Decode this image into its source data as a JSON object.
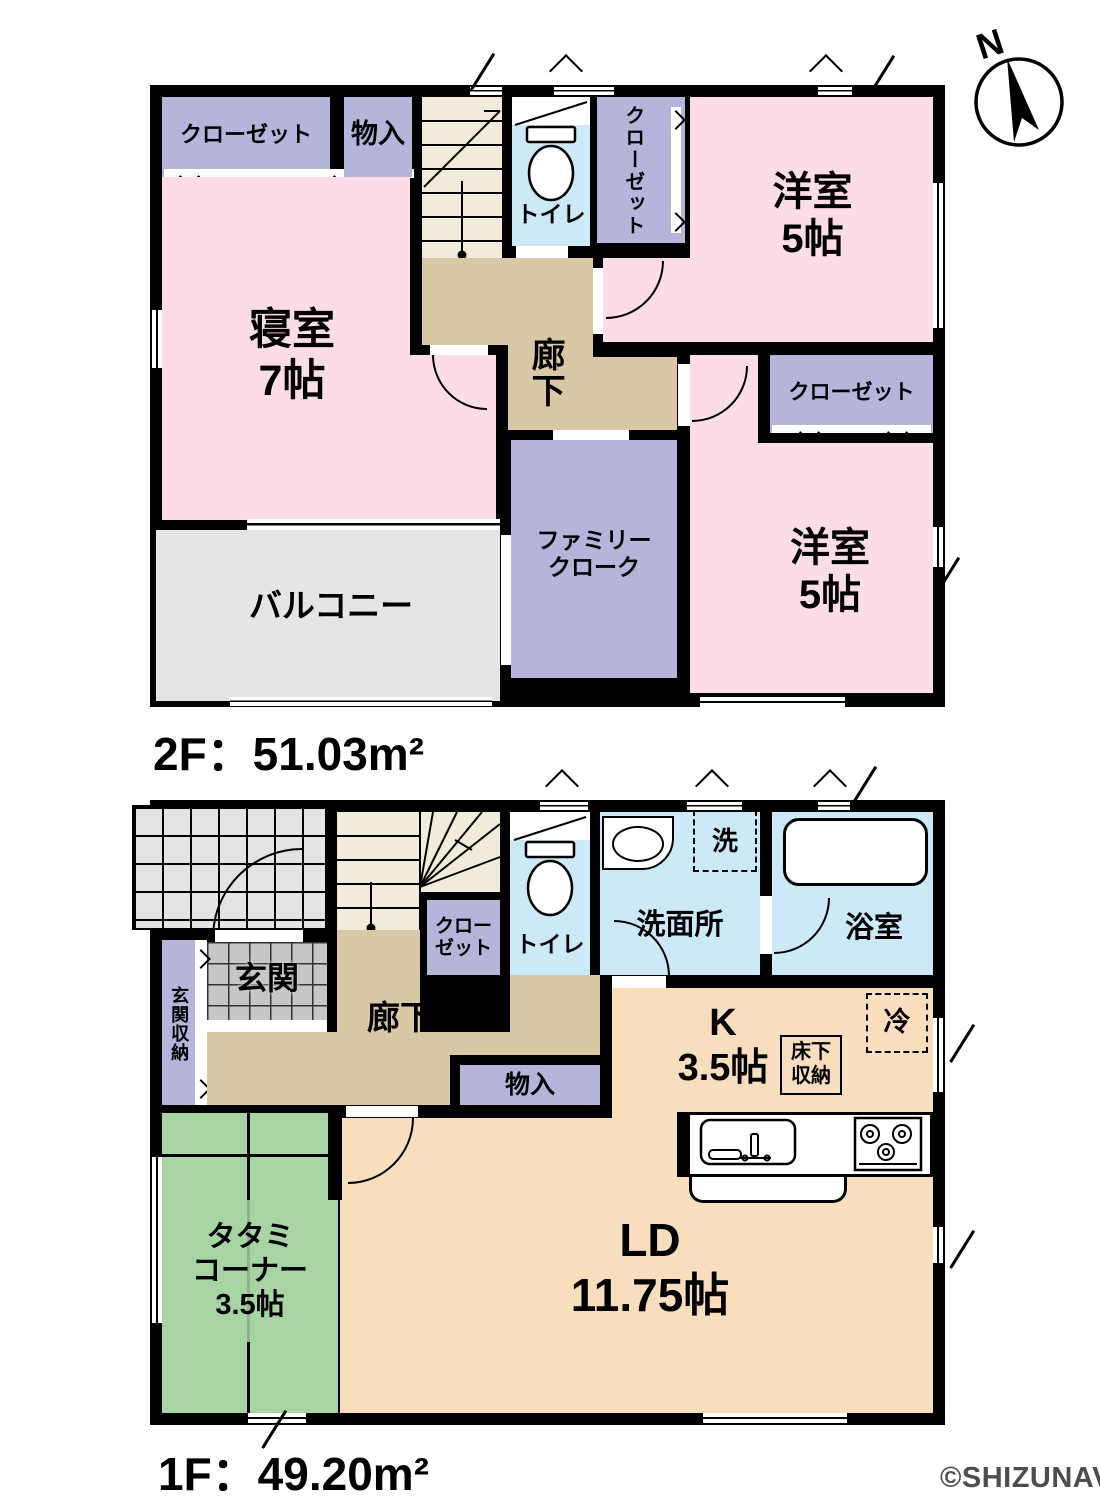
{
  "compass": {
    "label": "N"
  },
  "watermark": {
    "label": "©SHIZUNAVI"
  },
  "palette": {
    "wall": "#000000",
    "room_pink": "#FBDCE8",
    "closet_purple": "#B5B5DB",
    "hallway_tan": "#D9C8A4",
    "stairs_cream": "#F1ECDA",
    "water_blue": "#CBE9F6",
    "tatami_green": "#A7D4A3",
    "ld_peach": "#F8DEBD",
    "balcony_gray": "#E5E5E5",
    "porch_tile_gray": "#E3E3E3",
    "entrance_tile_gray": "#C7C7C7",
    "watermark_gray": "#4D4D4D"
  },
  "floor2": {
    "area_label": "2F：51.03m²",
    "rooms": {
      "closet_top_left": "クローゼット",
      "storage": "物入",
      "stairs_down": "DN",
      "toilet": "トイレ",
      "closet_upper": "クローゼット",
      "western_room_ne": "洋室\n5帖",
      "bedroom": "寝室\n7帖",
      "hallway": "廊下",
      "closet_east": "クローゼット",
      "family_closet": "ファミリー\nクローク",
      "western_room_se": "洋室\n5帖",
      "balcony": "バルコニー"
    }
  },
  "floor1": {
    "area_label": "1F：49.20m²",
    "rooms": {
      "entrance": "玄関",
      "entrance_storage": "玄関収納",
      "stairs_up": "UP",
      "closet": "クロー\nゼット",
      "toilet": "トイレ",
      "washroom": "洗面所",
      "washer_symbol": "洗",
      "bathroom": "浴室",
      "hallway": "廊下",
      "storage": "物入",
      "kitchen": "K\n3.5帖",
      "underfloor_storage": "床下\n収納",
      "refrigerator": "冷",
      "living_dining": "LD\n11.75帖",
      "tatami_corner": "タタミ\nコーナー\n3.5帖"
    }
  }
}
